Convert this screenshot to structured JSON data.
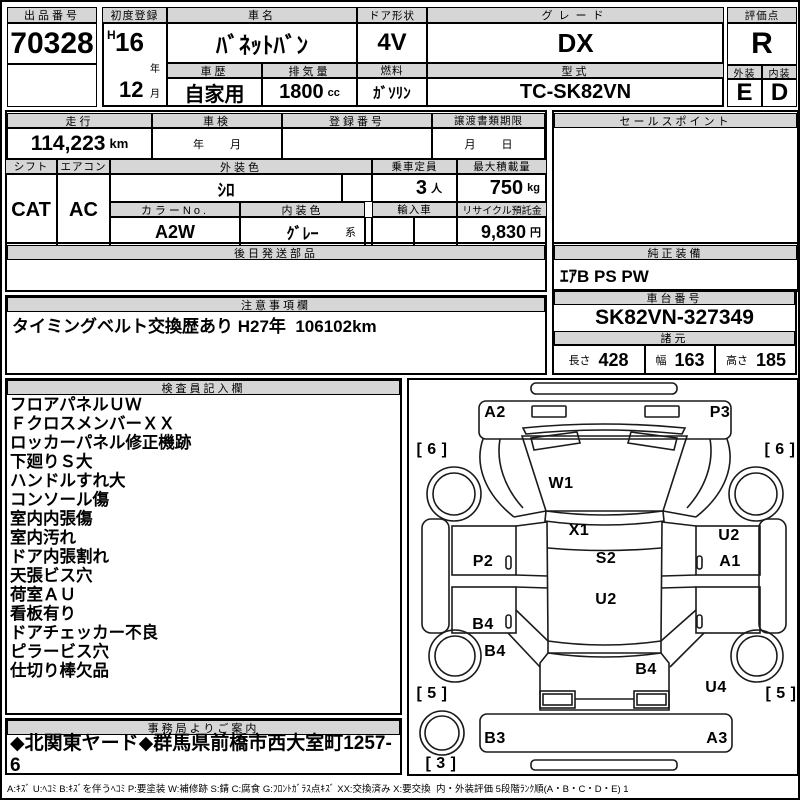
{
  "top": {
    "lot_label": "出品番号",
    "lot_value": "70328",
    "first_reg_label": "初度登録",
    "first_reg_era": "H",
    "first_reg_year": "16",
    "year_suffix": "年",
    "first_reg_month": "12",
    "month_suffix": "月",
    "car_name_label": "車名",
    "car_name": "ﾊﾞﾈｯﾄﾊﾞﾝ",
    "history_label": "車歴",
    "history": "自家用",
    "displacement_label": "排気量",
    "displacement": "1800",
    "displacement_unit": "cc",
    "door_label": "ドア形状",
    "door": "4V",
    "fuel_label": "燃料",
    "fuel": "ｶﾞｿﾘﾝ",
    "grade_label": "グレード",
    "grade": "DX",
    "model_label": "型式",
    "model": "TC-SK82VN",
    "score_label": "評価点",
    "score": "R",
    "exterior_label": "外装",
    "exterior": "E",
    "interior_label": "内装",
    "interior": "D"
  },
  "mid": {
    "mileage_label": "走行",
    "mileage": "114,223",
    "mileage_unit": "km",
    "shaken_label": "車検",
    "shaken_year": "年",
    "shaken_month": "月",
    "reg_no_label": "登録番号",
    "transfer_label": "譲渡書類期限",
    "transfer_month": "月",
    "transfer_day": "日",
    "sales_point_label": "セールスポイント",
    "shift_label": "シフト",
    "shift": "CAT",
    "aircon_label": "エアコン",
    "aircon": "AC",
    "ext_color_label": "外装色",
    "ext_color": "ｼﾛ",
    "capacity_label": "乗車定員",
    "capacity": "3",
    "capacity_unit": "人",
    "payload_label": "最大積載量",
    "payload": "750",
    "payload_unit": "kg",
    "color_no_label": "カラーNo.",
    "color_no": "A2W",
    "int_color_label": "内装色",
    "int_color": "ｸﾞﾚｰ",
    "int_color_suffix": "系",
    "import_label": "輸入車",
    "recycle_label": "リサイクル預託金",
    "recycle": "9,830",
    "recycle_unit": "円"
  },
  "parts": {
    "label": "後日発送部品"
  },
  "equipment": {
    "label": "純正装備",
    "value": "ｴｱB PS PW"
  },
  "notes": {
    "label": "注意事項欄",
    "value": "タイミングベルト交換歴あり H27年  106102km"
  },
  "chassis": {
    "label": "車台番号",
    "value": "SK82VN-327349",
    "spec_label": "諸元",
    "length_label": "長さ",
    "length": "428",
    "width_label": "幅",
    "width": "163",
    "height_label": "高さ",
    "height": "185"
  },
  "inspector": {
    "label": "検査員記入欄",
    "items": [
      "フロアパネルＵＷ",
      "ＦクロスメンバーＸＸ",
      "ロッカーパネル修正機跡",
      "下廻りＳ大",
      "ハンドルすれ大",
      "コンソール傷",
      "室内内張傷",
      "室内汚れ",
      "ドア内張割れ",
      "天張ビス穴",
      "荷室ＡＵ",
      "看板有り",
      "ドアチェッカー不良",
      "ピラービス穴",
      "仕切り棒欠品"
    ]
  },
  "office": {
    "label": "事務局よりご案内",
    "value": "◆北関東ヤード◆群馬県前橋市西大室町1257-6"
  },
  "diagram": {
    "labels": [
      {
        "text": "A2",
        "x": 86,
        "y": 33
      },
      {
        "text": "P3",
        "x": 311,
        "y": 33
      },
      {
        "text": "[ 6 ]",
        "x": 23,
        "y": 70
      },
      {
        "text": "[ 6 ]",
        "x": 371,
        "y": 70
      },
      {
        "text": "W1",
        "x": 152,
        "y": 104
      },
      {
        "text": "X1",
        "x": 170,
        "y": 151
      },
      {
        "text": "P2",
        "x": 74,
        "y": 182
      },
      {
        "text": "S2",
        "x": 197,
        "y": 179
      },
      {
        "text": "U2",
        "x": 320,
        "y": 156
      },
      {
        "text": "A1",
        "x": 321,
        "y": 182
      },
      {
        "text": "U2",
        "x": 197,
        "y": 220
      },
      {
        "text": "B4",
        "x": 74,
        "y": 245
      },
      {
        "text": "B4",
        "x": 86,
        "y": 272
      },
      {
        "text": "B4",
        "x": 237,
        "y": 290
      },
      {
        "text": "U4",
        "x": 307,
        "y": 308
      },
      {
        "text": "[ 5 ]",
        "x": 23,
        "y": 314
      },
      {
        "text": "[ 5 ]",
        "x": 372,
        "y": 314
      },
      {
        "text": "B3",
        "x": 86,
        "y": 359
      },
      {
        "text": "A3",
        "x": 308,
        "y": 359
      },
      {
        "text": "[ 3 ]",
        "x": 32,
        "y": 384
      }
    ]
  },
  "legend": "A:ｷｽﾞ U:ﾍｺﾐ B:ｷｽﾞを伴うﾍｺﾐ P:要塗装 W:補修跡 S:錆 C:腐食 G:ﾌﾛﾝﾄｶﾞﾗｽ点ｷｽﾞ XX:交換済み X:要交換  内・外装評価 5段階ﾗﾝｸ順(A・B・C・D・E) 1"
}
